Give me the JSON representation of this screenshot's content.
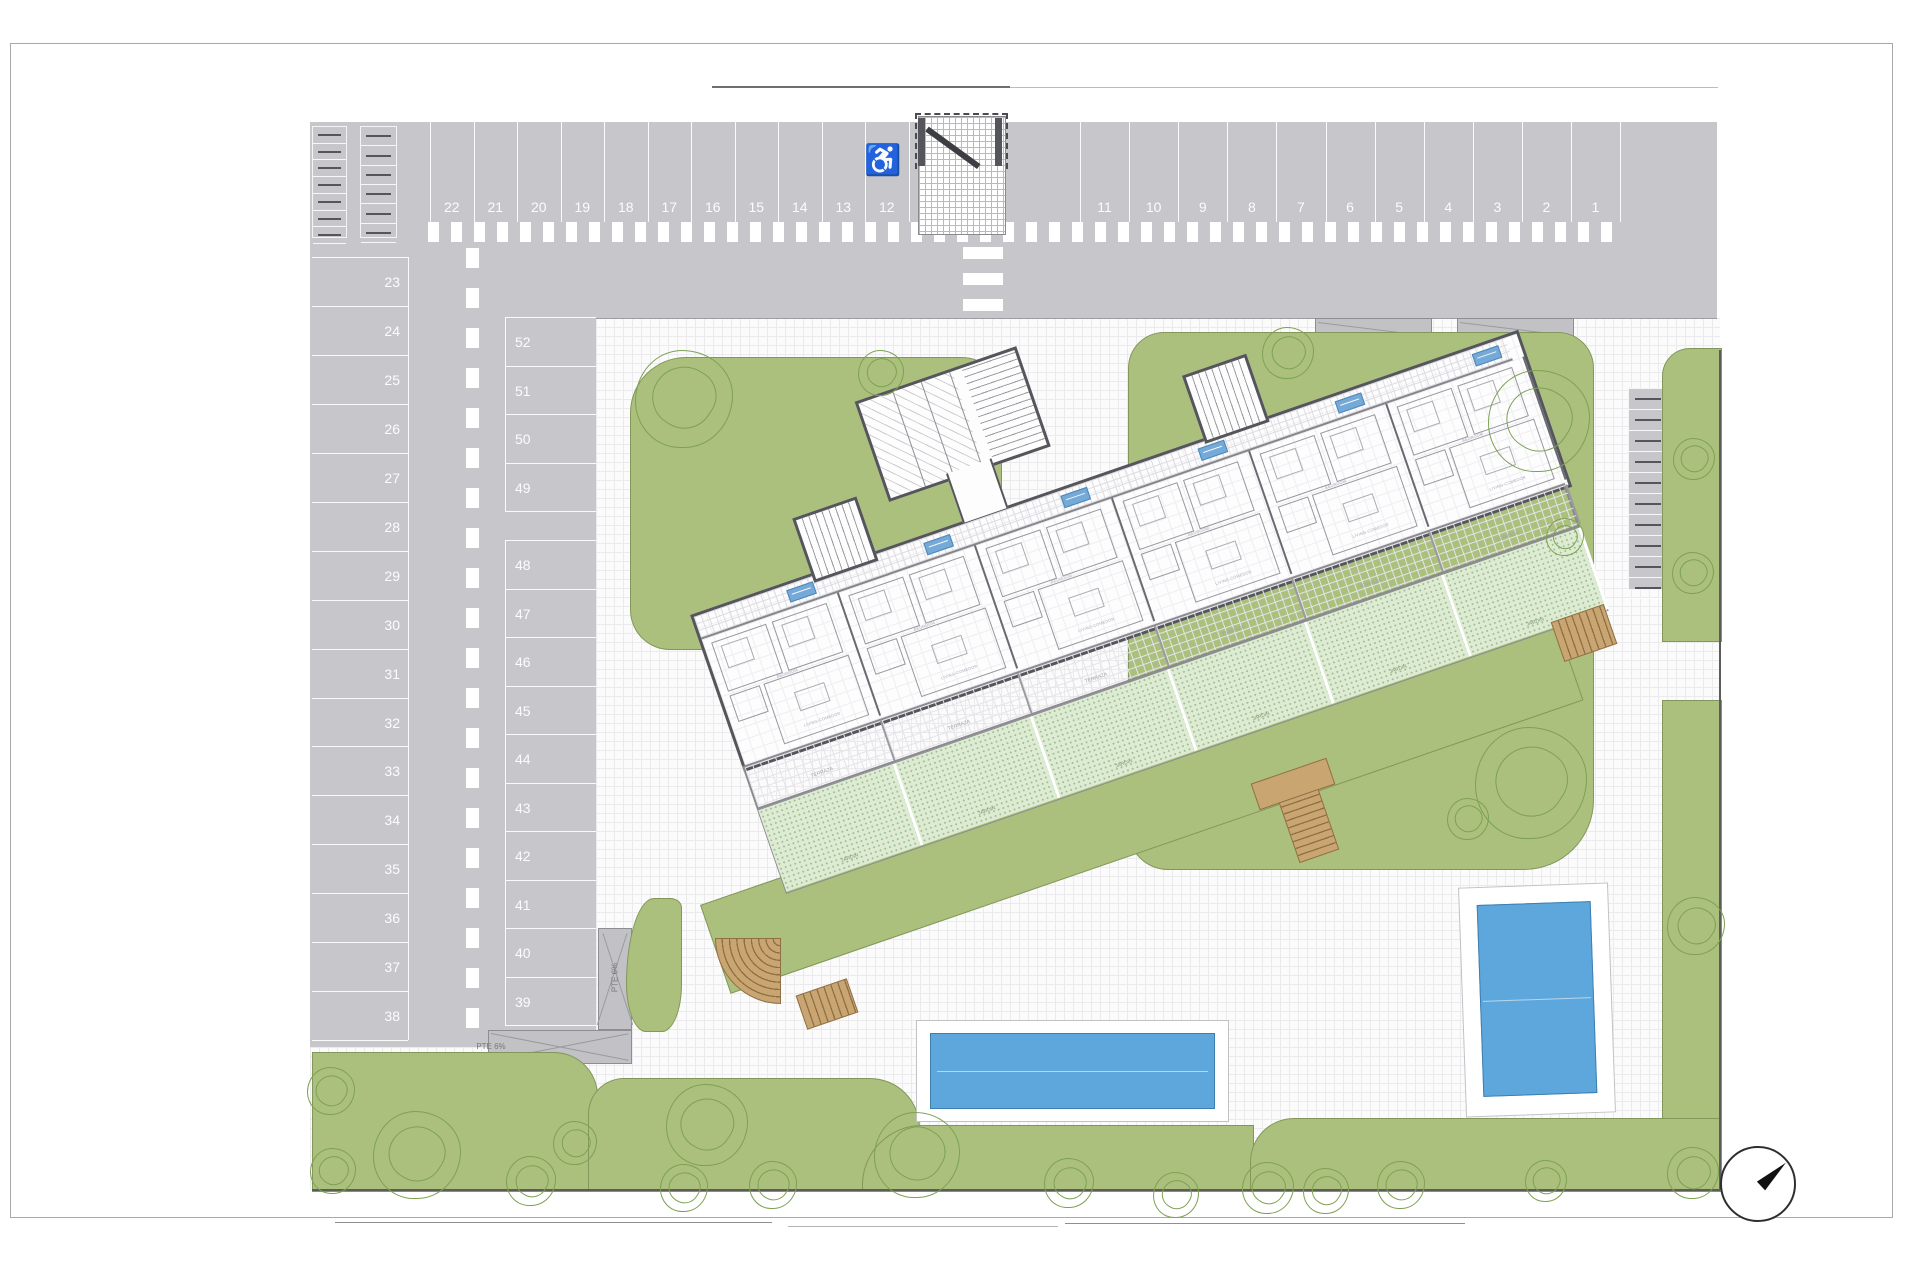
{
  "parking": {
    "top_row_left": [
      "22",
      "21",
      "20",
      "19",
      "18",
      "17",
      "16",
      "15",
      "14",
      "13",
      "12"
    ],
    "top_row_right": [
      "11",
      "10",
      "9",
      "8",
      "7",
      "6",
      "5",
      "4",
      "3",
      "2",
      "1"
    ],
    "left_column": [
      "23",
      "24",
      "25",
      "26",
      "27",
      "28",
      "29",
      "30",
      "31",
      "32",
      "33",
      "34",
      "35",
      "36",
      "37",
      "38"
    ],
    "inner_column_upper": [
      "52",
      "51",
      "50",
      "49"
    ],
    "inner_column_lower": [
      "48",
      "47",
      "46",
      "45",
      "44",
      "43",
      "42",
      "41",
      "40",
      "39"
    ],
    "accessible_space_icon": "♿"
  },
  "ramps": {
    "pte8": "PTE 8%",
    "pte6": "PTE 6%"
  },
  "building": {
    "terrace_label": "TERRAZA",
    "garden_label": "JARDIN",
    "living_label": "LIVING-COMEDOR",
    "bedroom_label": "BEDROOM"
  },
  "colors": {
    "road": "#c7c7cb",
    "lawn": "#abc07d",
    "pool": "#5ea7dc",
    "private_garden": "#ddebd2",
    "stairs": "#c9a571",
    "unit_tag": "#74a9d8"
  }
}
